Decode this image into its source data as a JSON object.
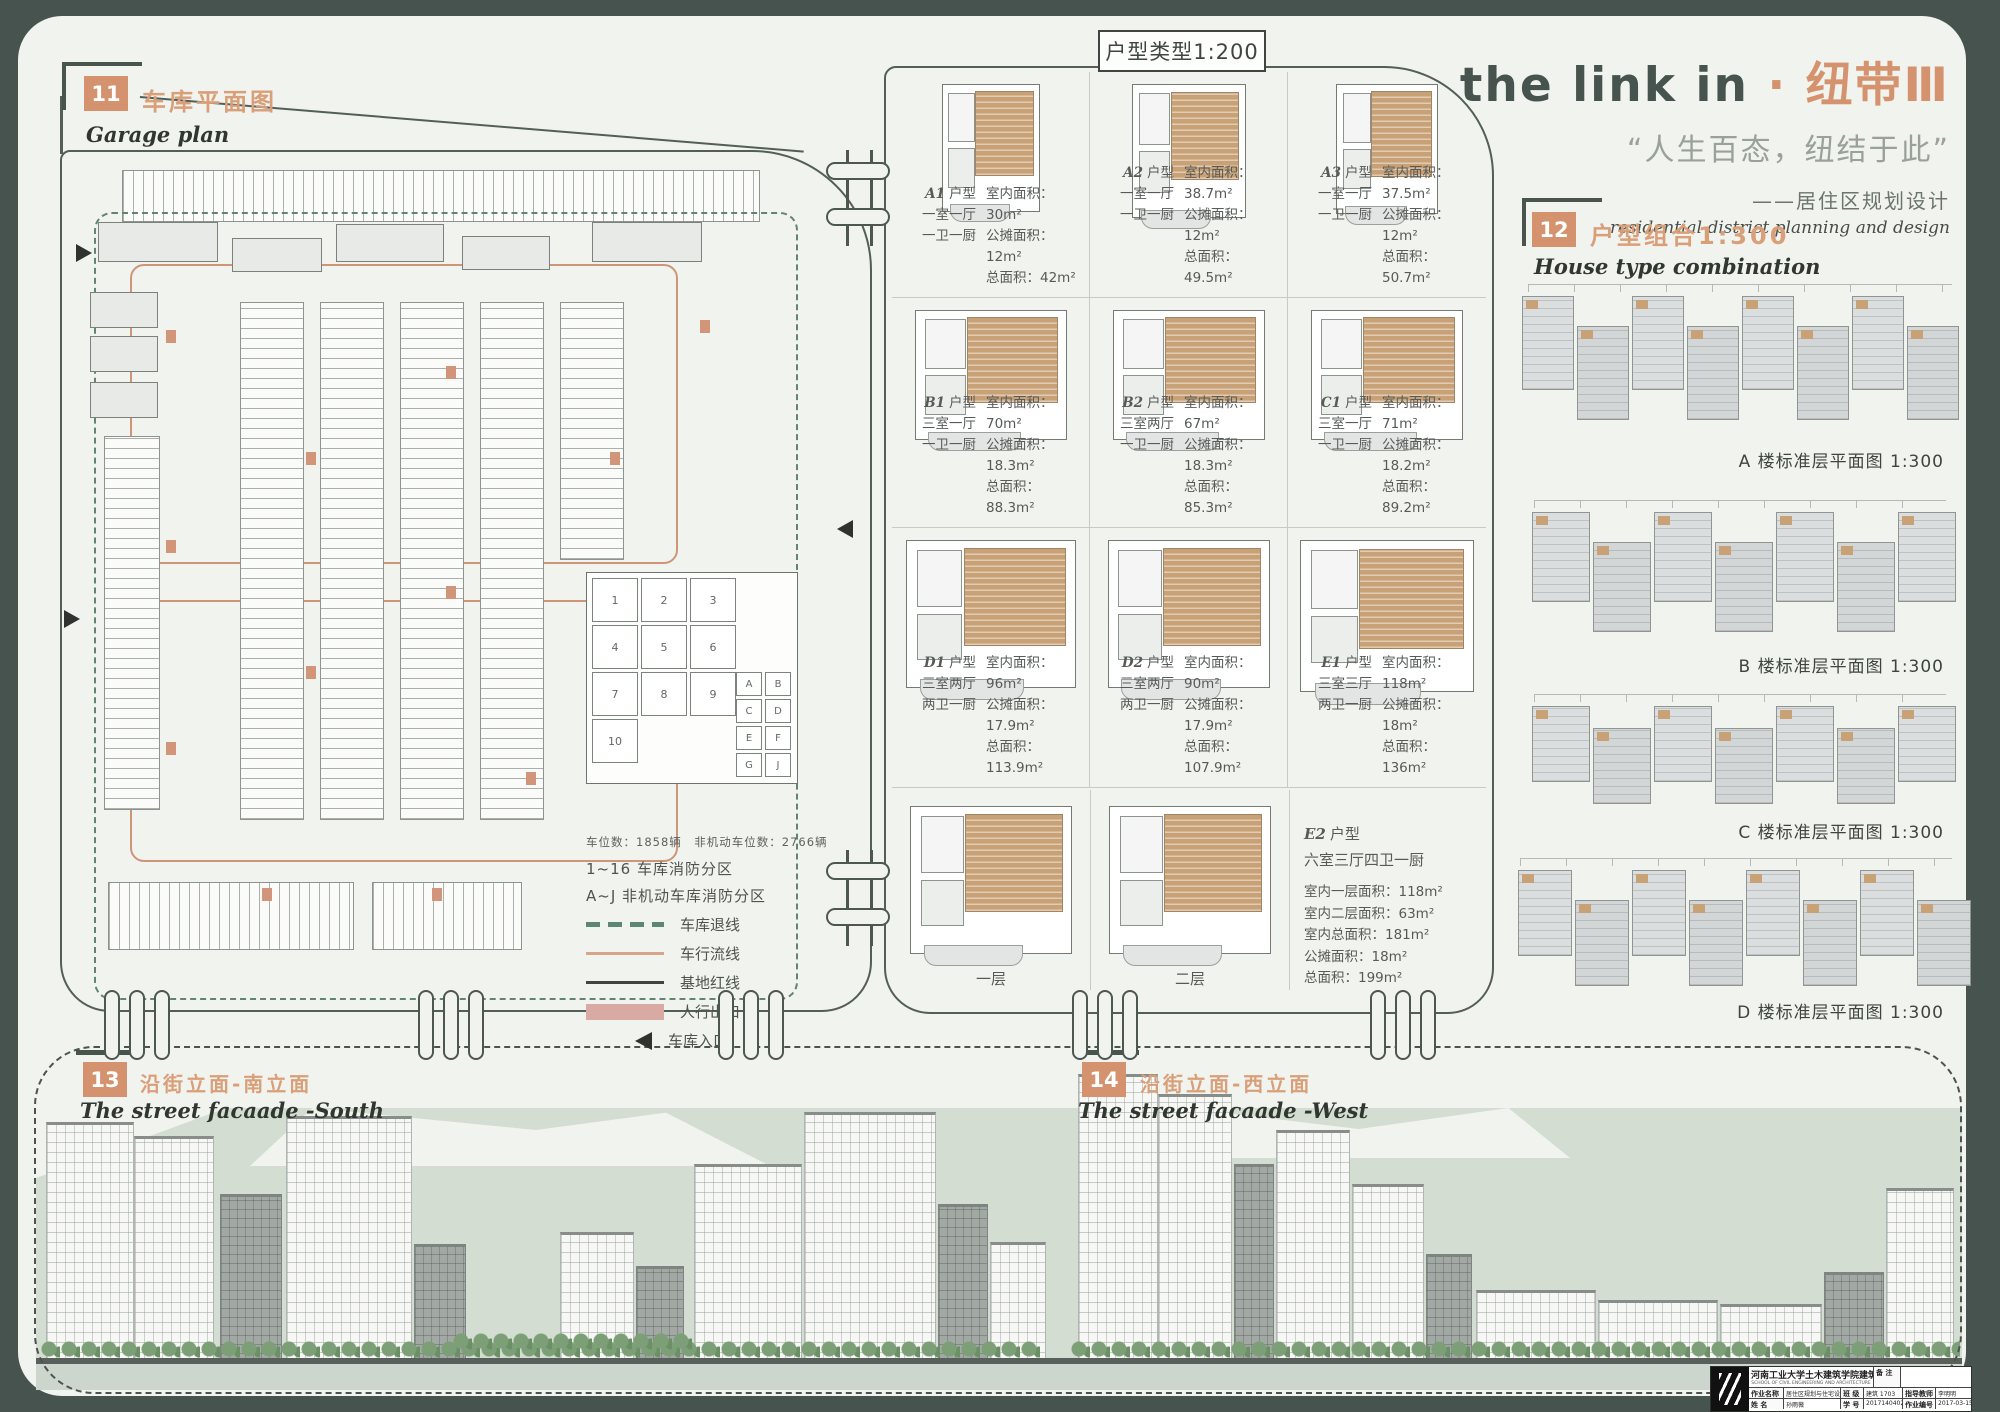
{
  "title": {
    "en": "the link in",
    "dot": "·",
    "cn": "纽带Ⅲ",
    "quote": "“人生百态，纽结于此”",
    "sub_cn": "——居住区规划设计",
    "sub_en": "residential district planning and design"
  },
  "garage": {
    "num": "11",
    "heading": "车库平面图",
    "heading_en": "Garage plan",
    "stats": "车位数：1858辆　非机动车位数：2766辆",
    "zone1": "1~16 车库消防分区",
    "zone2": "A~J 非机动车库消防分区",
    "legend": [
      "车库退线",
      "车行流线",
      "基地红线",
      "人行出口",
      "车库入口"
    ],
    "fire_zones": [
      "1",
      "2",
      "3",
      "4",
      "5",
      "6",
      "7",
      "8",
      "9",
      "10"
    ],
    "bike_zones": [
      "A",
      "B",
      "C",
      "D",
      "E",
      "F",
      "G",
      "J"
    ]
  },
  "units": {
    "header": "户型类型1:200",
    "suffix": "户型",
    "items": [
      {
        "code": "A1",
        "rooms": "一室一厅",
        "bath": "一卫一厨",
        "interior": "室内面积：30m²",
        "shared": "公摊面积：12m²",
        "total": "总面积：42m²"
      },
      {
        "code": "A2",
        "rooms": "一室一厅",
        "bath": "一卫一厨",
        "interior": "室内面积：38.7m²",
        "shared": "公摊面积：12m²",
        "total": "总面积：49.5m²"
      },
      {
        "code": "A3",
        "rooms": "一室一厅",
        "bath": "一卫一厨",
        "interior": "室内面积：37.5m²",
        "shared": "公摊面积：12m²",
        "total": "总面积：50.7m²"
      },
      {
        "code": "B1",
        "rooms": "三室一厅",
        "bath": "一卫一厨",
        "interior": "室内面积：70m²",
        "shared": "公摊面积：18.3m²",
        "total": "总面积：88.3m²"
      },
      {
        "code": "B2",
        "rooms": "三室两厅",
        "bath": "一卫一厨",
        "interior": "室内面积：67m²",
        "shared": "公摊面积：18.3m²",
        "total": "总面积：85.3m²"
      },
      {
        "code": "C1",
        "rooms": "三室一厅",
        "bath": "一卫一厨",
        "interior": "室内面积：71m²",
        "shared": "公摊面积：18.2m²",
        "total": "总面积：89.2m²"
      },
      {
        "code": "D1",
        "rooms": "三室两厅",
        "bath": "两卫一厨",
        "interior": "室内面积：96m²",
        "shared": "公摊面积：17.9m²",
        "total": "总面积：113.9m²"
      },
      {
        "code": "D2",
        "rooms": "三室两厅",
        "bath": "两卫一厨",
        "interior": "室内面积：90m²",
        "shared": "公摊面积：17.9m²",
        "total": "总面积：107.9m²"
      },
      {
        "code": "E1",
        "rooms": "三室三厅",
        "bath": "两卫一厨",
        "interior": "室内面积：118m²",
        "shared": "公摊面积：18m²",
        "total": "总面积：136m²"
      }
    ],
    "e2": {
      "code": "E2",
      "layout": "六室三厅四卫一厨",
      "l1": "室内一层面积：118m²",
      "l2": "室内二层面积：63m²",
      "l3": "室内总面积：181m²",
      "l4": "公摊面积：18m²",
      "l5": "总面积：199m²",
      "floor1": "一层",
      "floor2": "二层"
    }
  },
  "combo": {
    "num": "12",
    "heading": "户型组合1:300",
    "heading_en": "House type combination",
    "captions": [
      "A 楼标准层平面图 1:300",
      "B 楼标准层平面图 1:300",
      "C 楼标准层平面图 1:300",
      "D 楼标准层平面图 1:300"
    ]
  },
  "facades": {
    "south": {
      "num": "13",
      "heading": "沿街立面-南立面",
      "heading_en": "The street facaade -South"
    },
    "west": {
      "num": "14",
      "heading": "沿街立面-西立面",
      "heading_en": "The street facaade -West"
    }
  },
  "titleblock": {
    "school": "河南工业大学土木建筑学院建筑系",
    "en1": "ARCHITECTURE DEPARTMENT",
    "en2": "SCHOOL OF CIVIL ENGINEERING AND ARCHITECTURE",
    "en3": "HENAN UNIVERSITY OF TECHNOLOGY (HAUT)",
    "remark": "备 注",
    "f1l": "作业名称",
    "f1v": "居住区规划与住宅设计",
    "f2l": "班 级",
    "f2v": "建筑 1703",
    "f3l": "指导教师",
    "f3v": "李明明",
    "f4l": "姓 名",
    "f4v": "孙雨薇",
    "f5l": "学 号",
    "f5v": "201714040218",
    "f6l": "作业编号",
    "f6v": "2017-03-15"
  },
  "colors": {
    "accent": "#d4936e",
    "frame": "#47534e",
    "band": "#d4ddd1",
    "legend_green": "#5f8573",
    "legend_pink": "#d9a9a4"
  }
}
